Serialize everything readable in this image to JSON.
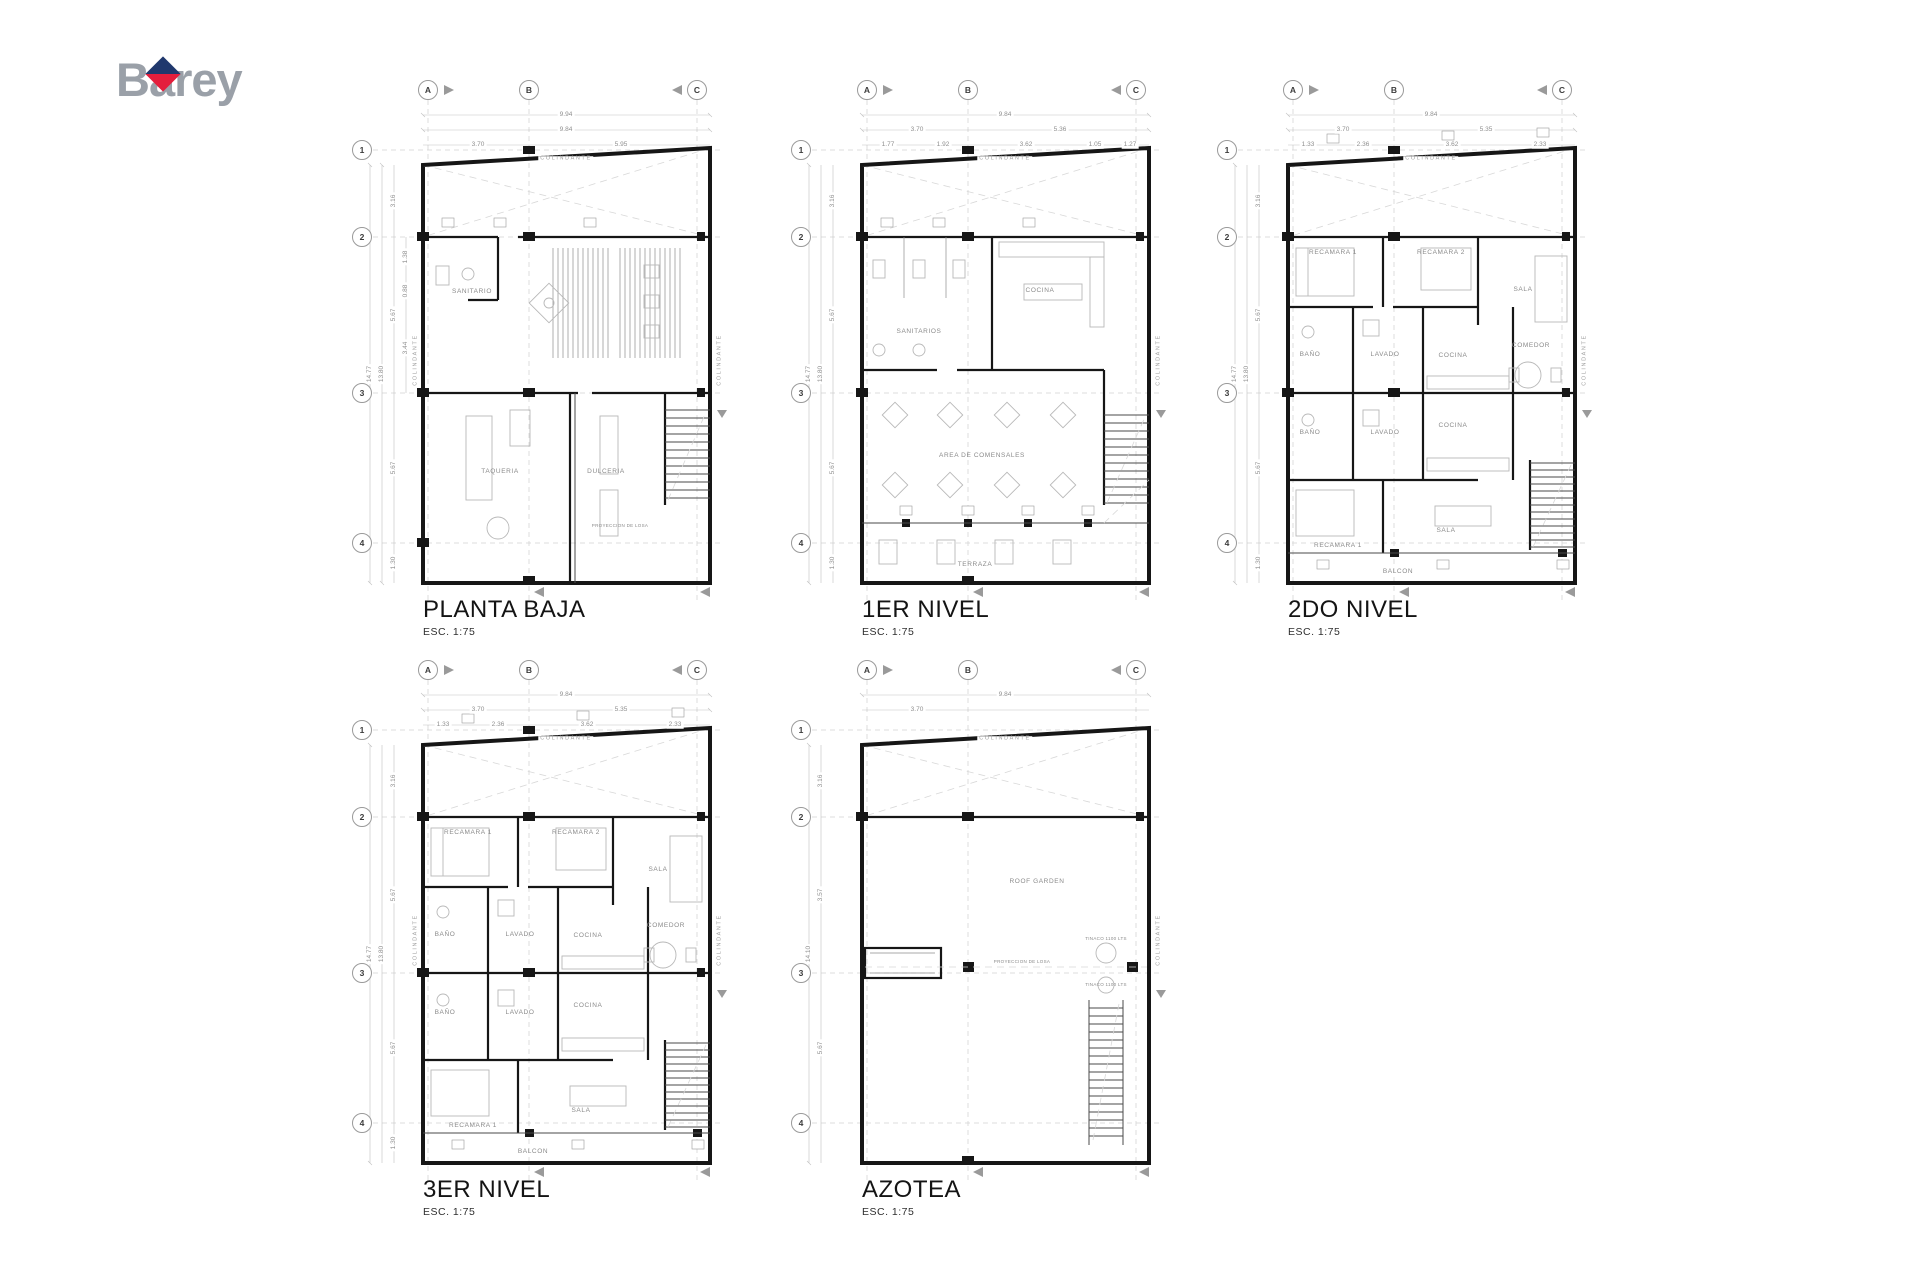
{
  "logo": {
    "part1": "B",
    "part2": "a",
    "part3": "rey",
    "gray": "#9aa0a8",
    "blue": "#20386d",
    "red": "#e41e3c"
  },
  "labels": {
    "colindante": "COLINDANTE",
    "proyeccion": "PROYECCION DE LOSA"
  },
  "grid": {
    "cols": [
      "A",
      "B",
      "C"
    ],
    "rows": [
      "1",
      "2",
      "3",
      "4"
    ]
  },
  "plans": [
    {
      "title": "PLANTA BAJA",
      "scale": "ESC. 1:75",
      "top_dims": {
        "total": "9.94",
        "subtotal": "9.84",
        "seg1": "3.70",
        "seg2": "5.95"
      },
      "left_dims": {
        "total": "14.77",
        "subtotal": "13.80",
        "segs": [
          "3.16",
          "5.67",
          "5.67",
          "1.30"
        ],
        "inner": [
          "1.38",
          "0.88",
          "3.44"
        ]
      },
      "rooms": {
        "sanitario": "SANITARIO",
        "taqueria": "TAQUERIA",
        "dulceria": "DULCERIA"
      }
    },
    {
      "title": "1ER NIVEL",
      "scale": "ESC. 1:75",
      "top_dims": {
        "total": "9.84",
        "seg1": "3.70",
        "seg2": "5.36",
        "row2": [
          "1.77",
          "1.92",
          "3.62",
          "1.05",
          "1.27"
        ]
      },
      "left_dims": {
        "total": "14.77",
        "subtotal": "13.80",
        "segs": [
          "3.16",
          "5.67",
          "5.67",
          "1.30"
        ]
      },
      "rooms": {
        "sanitarios": "SANITARIOS",
        "cocina": "COCINA",
        "comensales": "AREA DE COMENSALES",
        "terraza": "TERRAZA"
      }
    },
    {
      "title": "2DO NIVEL",
      "scale": "ESC. 1:75",
      "top_dims": {
        "total": "9.84",
        "seg1": "3.70",
        "seg2": "5.35",
        "row2": [
          "1.33",
          "2.36",
          "3.62",
          "2.33"
        ]
      },
      "left_dims": {
        "total": "14.77",
        "subtotal": "13.80",
        "segs": [
          "3.16",
          "5.67",
          "5.67",
          "1.30"
        ]
      },
      "rooms": {
        "recamara1": "RECAMARA 1",
        "recamara2": "RECAMARA 2",
        "sala": "SALA",
        "bano": "BAÑO",
        "lavado": "LAVADO",
        "cocina": "COCINA",
        "comedor": "COMEDOR",
        "bano2": "BAÑO",
        "lavado2": "LAVADO",
        "cocina2": "COCINA",
        "sala2": "SALA",
        "recamara1b": "RECAMARA 1",
        "balcon": "BALCON"
      }
    },
    {
      "title": "3ER NIVEL",
      "scale": "ESC. 1:75",
      "top_dims": {
        "total": "9.84",
        "seg1": "3.70",
        "seg2": "5.35",
        "row2": [
          "1.33",
          "2.36",
          "3.62",
          "2.33"
        ]
      },
      "left_dims": {
        "total": "14.77",
        "subtotal": "13.80",
        "segs": [
          "3.16",
          "5.67",
          "5.67",
          "1.30"
        ]
      },
      "rooms": {
        "recamara1": "RECAMARA 1",
        "recamara2": "RECAMARA 2",
        "sala": "SALA",
        "bano": "BAÑO",
        "lavado": "LAVADO",
        "cocina": "COCINA",
        "comedor": "COMEDOR",
        "bano2": "BAÑO",
        "lavado2": "LAVADO",
        "cocina2": "COCINA",
        "sala2": "SALA",
        "recamara1b": "RECAMARA 1",
        "balcon": "BALCON"
      }
    },
    {
      "title": "AZOTEA",
      "scale": "ESC. 1:75",
      "top_dims": {
        "total": "9.84",
        "seg1": "3.70"
      },
      "left_dims": {
        "total": "14.10",
        "segs": [
          "3.16",
          "3.57",
          "5.67"
        ]
      },
      "rooms": {
        "roof": "ROOF GARDEN"
      },
      "tinacos": [
        "TINACO 1100 LTS",
        "TINACO 1100 LTS"
      ]
    }
  ]
}
